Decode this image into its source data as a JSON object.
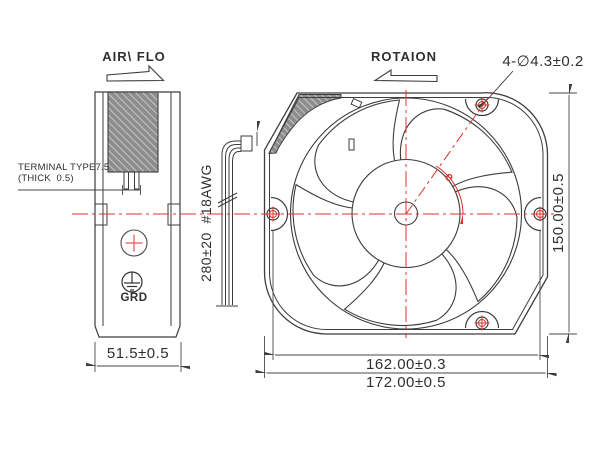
{
  "labels": {
    "air_flow": "AIR\\ FLO",
    "rotation": "ROTAION",
    "mounting_holes": "4-∅4.3±0.2",
    "frame_height": "150.00±0.5",
    "hole_pitch": "162.00±0.3",
    "frame_width": "172.00±0.5",
    "frame_depth": "51.5±0.5",
    "lead_wire": "280±20  #18AWG",
    "terminal_line1": "TERMINAL TYPE7.5",
    "terminal_line2": "(THICK  0.5)",
    "ground": "GRD",
    "rotation_mark": "e"
  },
  "colors": {
    "line": "#3d3d3d",
    "centerline_red": "#d8362c",
    "hatch_gray": "#8d8d8d",
    "background": "#ffffff"
  }
}
